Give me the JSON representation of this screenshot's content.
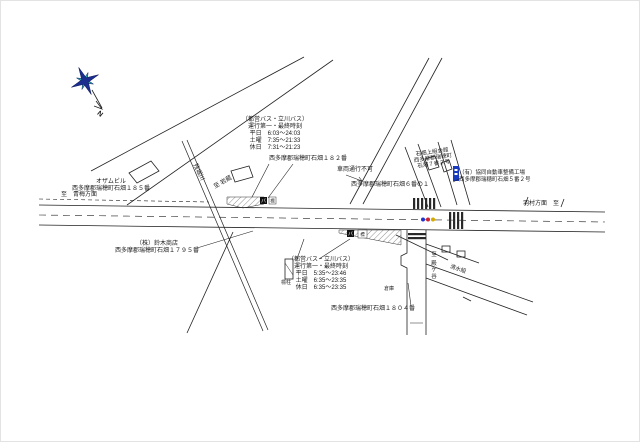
{
  "compass": {
    "north_label": "N",
    "primary_color": "#1b2d8e",
    "secondary_color": "#2ea8a4"
  },
  "signal": {
    "colors": [
      "#2233cc",
      "#cc2233",
      "#d4a900"
    ]
  },
  "signs": {
    "blue_sign_color": "#1a3bbd"
  },
  "bus_stops": {
    "north": {
      "operator": "（都営バス・立川バス）",
      "schedule_title": "運行第一・最終時刻",
      "weekday": "平日　6:03〜24:03",
      "saturday": "土曜　7:35〜21:33",
      "holiday": "休日　7:31〜21:23",
      "address": "西多摩郡瑞穂町石畑１８２番",
      "sign_glyph": "バ",
      "sign_box": "標"
    },
    "south": {
      "operator": "（都営バス・立川バス）",
      "schedule_title": "運行第一・最終時刻",
      "weekday": "平日　5:35〜23:46",
      "saturday": "土曜　6:35〜23:35",
      "holiday": "休日　6:35〜23:35",
      "pole_label": "標柱",
      "sign_glyph": "バ",
      "sign_box": "標"
    }
  },
  "labels": {
    "to_ome": "至　青梅方面",
    "to_hamura": "羽村方面　至",
    "river": "残堀川",
    "to_iwakura": "至 岩蔵",
    "ozam_building": "オザムビル",
    "ozam_address": "西多摩郡瑞穂町石畑１８５番",
    "suzuki_company": "（株）鈴木商店",
    "suzuki_address": "西多摩郡瑞穂町石畑１７９５番",
    "no_vehicles": "車両通行不可",
    "ishihata6_address": "西多摩郡瑞穂町石畑６番の１",
    "community_hall": "石畑上組会館",
    "community_hall_addr1": "西多摩郡瑞穂町",
    "community_hall_addr2": "石畑７番２号",
    "auto_shop": "（有）協同自動車整備工場",
    "auto_shop_address": "西多摩郡瑞穂町石畑５番２号",
    "lot_1804": "西多摩郡瑞穂町石畑１８０４番",
    "to_tonogaya": "至 殿ケ谷",
    "shimizu": "清水組",
    "warehouse": "倉庫"
  }
}
